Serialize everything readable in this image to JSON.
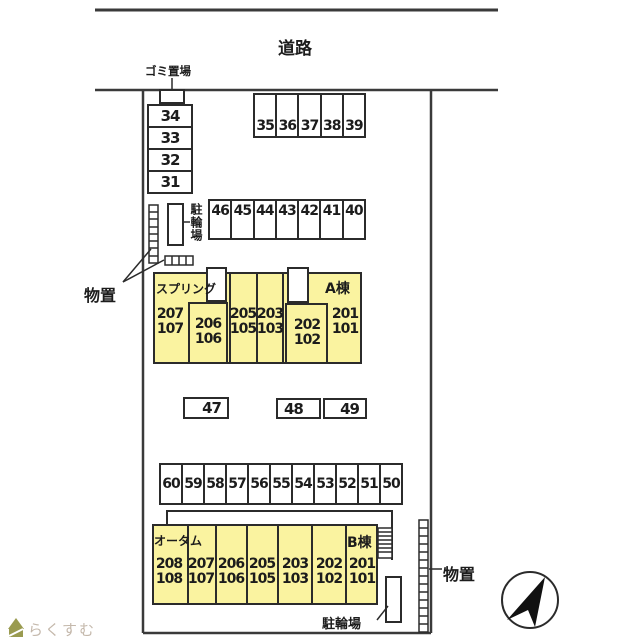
{
  "labels": {
    "road": "道路",
    "garbage": "ゴミ置場",
    "bicycle_top": "駐輪場",
    "bicycle_bottom": "駐輪場",
    "storage_left": "物置",
    "storage_right": "物置",
    "logo": "らくすむ"
  },
  "parking": {
    "stack_left": [
      "34",
      "33",
      "32",
      "31"
    ],
    "row_top": [
      "35",
      "36",
      "37",
      "38",
      "39"
    ],
    "row_mid": [
      "46",
      "45",
      "44",
      "43",
      "42",
      "41",
      "40"
    ],
    "middle_boxes": [
      "47",
      "48",
      "49"
    ],
    "row_lower": [
      "60",
      "59",
      "58",
      "57",
      "56",
      "55",
      "54",
      "53",
      "52",
      "51",
      "50"
    ]
  },
  "building_a": {
    "name": "スプリング",
    "tag": "A棟",
    "units": [
      {
        "upper": "207",
        "lower": "107"
      },
      {
        "upper": "206",
        "lower": "106"
      },
      {
        "upper": "205",
        "lower": "105"
      },
      {
        "upper": "203",
        "lower": "103"
      },
      {
        "upper": "202",
        "lower": "102"
      },
      {
        "upper": "201",
        "lower": "101"
      }
    ]
  },
  "building_b": {
    "name": "オータム",
    "tag": "B棟",
    "units": [
      {
        "upper": "208",
        "lower": "108"
      },
      {
        "upper": "207",
        "lower": "107"
      },
      {
        "upper": "206",
        "lower": "106"
      },
      {
        "upper": "205",
        "lower": "105"
      },
      {
        "upper": "203",
        "lower": "103"
      },
      {
        "upper": "202",
        "lower": "102"
      },
      {
        "upper": "201",
        "lower": "101"
      }
    ]
  },
  "colors": {
    "building_fill": "#FAF3A0",
    "line": "#2b2b2b",
    "boundary": "#4a4a4a",
    "logo_text": "#c4b8ab",
    "logo_green": "#9a9b50"
  }
}
